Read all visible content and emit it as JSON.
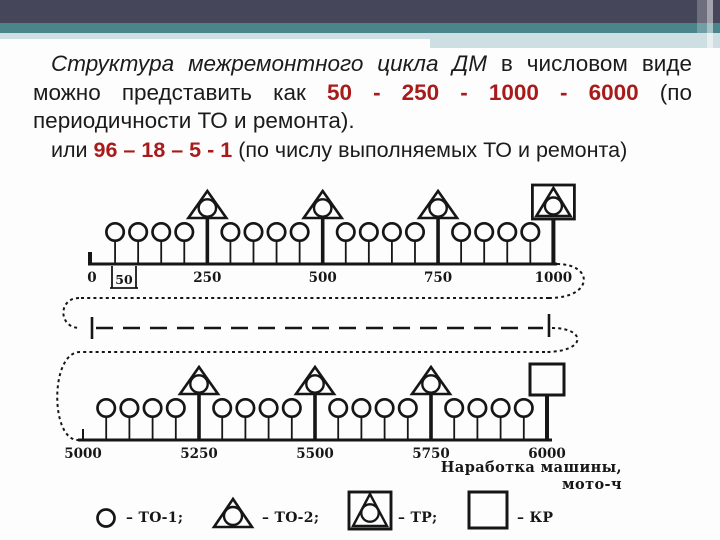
{
  "colors": {
    "header_dark": "#45465a",
    "header_teal": "#4a858c",
    "header_light": "#cedfe3",
    "red_accent": "#a81b1b",
    "ink": "#161616"
  },
  "text_block": {
    "lines": [
      {
        "indent": true,
        "justify": true,
        "segments": [
          {
            "t": "Структура межремонтного цикла ДМ",
            "s": "it"
          },
          {
            "t": " в числовом виде",
            "s": "n"
          }
        ]
      },
      {
        "indent": false,
        "justify": true,
        "segments": [
          {
            "t": "можно представить как ",
            "s": "n"
          },
          {
            "t": "50 - 250 - 1000 - 6000",
            "s": "rb"
          },
          {
            "t": " (по",
            "s": "n"
          }
        ]
      },
      {
        "indent": false,
        "justify": false,
        "segments": [
          {
            "t": "периодичности ТО и ремонта).",
            "s": "n"
          }
        ]
      },
      {
        "indent": true,
        "justify": false,
        "small": true,
        "segments": [
          {
            "t": "или ",
            "s": "n"
          },
          {
            "t": "96 – 18 – 5 - 1",
            "s": "rb"
          },
          {
            "t": " (по числу выполняемых ТО и ремонта)",
            "s": "n"
          }
        ]
      }
    ]
  },
  "diagram": {
    "axis_label": "Наработка машины, мото-ч",
    "rows": [
      {
        "start": 0,
        "end": 1000,
        "ticks": [
          {
            "v": 0,
            "label": "0"
          },
          {
            "v": 250,
            "label": "250"
          },
          {
            "v": 500,
            "label": "500"
          },
          {
            "v": 750,
            "label": "750"
          },
          {
            "v": 1000,
            "label": "1000"
          }
        ],
        "interval_label": "50",
        "to1": [
          50,
          100,
          150,
          200,
          300,
          350,
          400,
          450,
          550,
          600,
          650,
          700,
          800,
          850,
          900,
          950
        ],
        "to2": [
          250,
          500,
          750
        ],
        "end_symbol": {
          "v": 1000,
          "type": "tr"
        }
      },
      {
        "start": 5000,
        "end": 6000,
        "ticks": [
          {
            "v": 5000,
            "label": "5000"
          },
          {
            "v": 5250,
            "label": "5250"
          },
          {
            "v": 5500,
            "label": "5500"
          },
          {
            "v": 5750,
            "label": "5750"
          },
          {
            "v": 6000,
            "label": "6000"
          }
        ],
        "to1": [
          5050,
          5100,
          5150,
          5200,
          5300,
          5350,
          5400,
          5450,
          5550,
          5600,
          5650,
          5700,
          5800,
          5850,
          5900,
          5950
        ],
        "to2": [
          5250,
          5500,
          5750
        ],
        "end_symbol": {
          "v": 6000,
          "type": "kr"
        }
      }
    ],
    "legend": [
      {
        "symbol": "to1",
        "label": "– ТО-1;"
      },
      {
        "symbol": "to2",
        "label": "– ТО-2;"
      },
      {
        "symbol": "tr",
        "label": "– ТР;"
      },
      {
        "symbol": "kr",
        "label": "– КР"
      }
    ]
  }
}
